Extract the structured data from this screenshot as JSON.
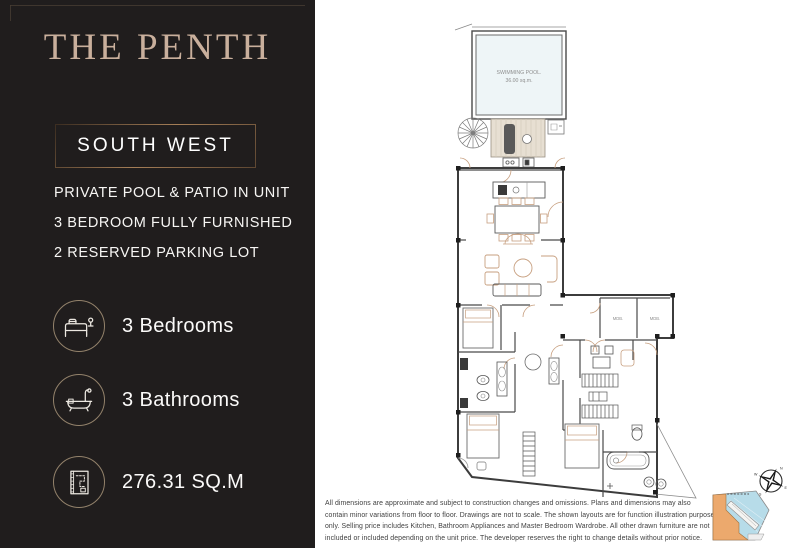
{
  "panel": {
    "title": "THE PENTH",
    "orientation": "SOUTH WEST",
    "features": [
      "PRIVATE POOL & PATIO IN UNIT",
      "3 BEDROOM FULLY FURNISHED",
      "2 RESERVED PARKING LOT"
    ],
    "stats": [
      {
        "icon": "bed-icon",
        "label": "3 Bedrooms"
      },
      {
        "icon": "bathtub-icon",
        "label": "3 Bathrooms"
      },
      {
        "icon": "floor-plan-icon",
        "label": "276.31 SQ.M"
      }
    ]
  },
  "floorplan": {
    "pool_label": "SWIMMING POOL.",
    "pool_area": "36.00 sq.m.",
    "rooms": {
      "mdb1": "MDB.",
      "mdb2": "MDB."
    },
    "compass": {
      "n": "N",
      "e": "E",
      "s": "S",
      "w": "W"
    }
  },
  "disclaimer": "All dimensions are approximate and subject to construction changes and omissions. Plans and dimensions may also contain minor variations from floor to floor. Drawings are not to scale. The shown layouts are for function illustration purpose only. Selling price includes Kitchen, Bathroom Appliances and Master Bedroom Wardrobe. All other drawn furniture are not included or included depending on the unit price. The developer reserves the right to change details without prior notice.",
  "colors": {
    "panel_bg": "#201d1d",
    "title": "#c9af9c",
    "accent_border": "#a57e57",
    "circle_border": "#93826b",
    "plan_wall": "#3c3c3c",
    "plan_accent": "#c79f7f",
    "pool_fill": "#eef5f7",
    "deck_fill": "#e7dfd2",
    "keymap_blue": "#b7dce9",
    "keymap_orange": "#eca96d"
  }
}
